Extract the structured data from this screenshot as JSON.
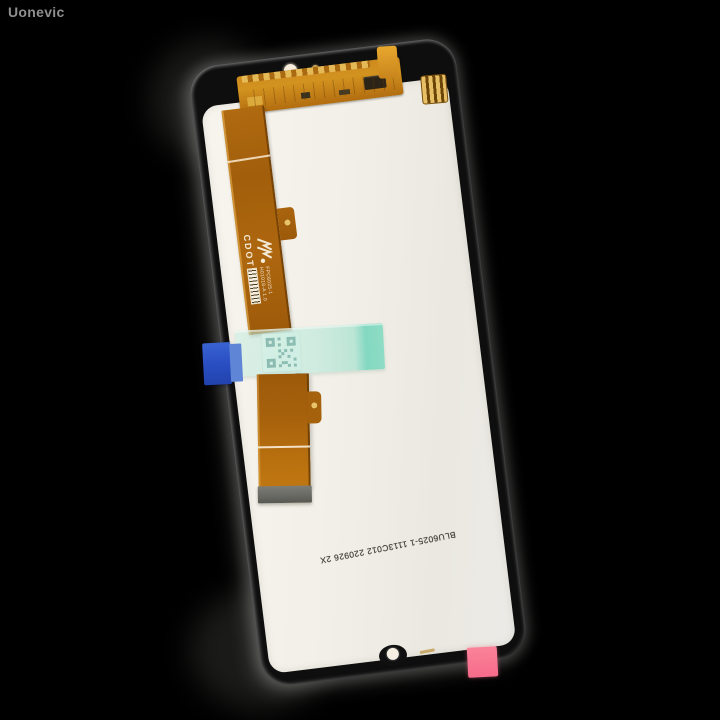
{
  "watermark": {
    "text": "Uonevic"
  },
  "photo": {
    "subject": "Replacement phone LCD display assembly, back side with flex cable, on black background",
    "background_color": "#000000"
  },
  "device": {
    "frame_color": "#0e0e0e",
    "panel_color": "#efede5",
    "flex_cable_color": "#b06a10",
    "tape_color": "#bfe8da",
    "tape_tab_color": "#2b50c4",
    "pink_tab_color": "#f9738f",
    "connector_stiffener_color": "#6a6a64",
    "labels": {
      "brand_print": "CDOT",
      "flex_part_number": "FPC6025-1",
      "flex_sub_line": "H01018-A 1.0",
      "panel_print": "BLU6025-1 1113C012 220926 2X"
    }
  }
}
